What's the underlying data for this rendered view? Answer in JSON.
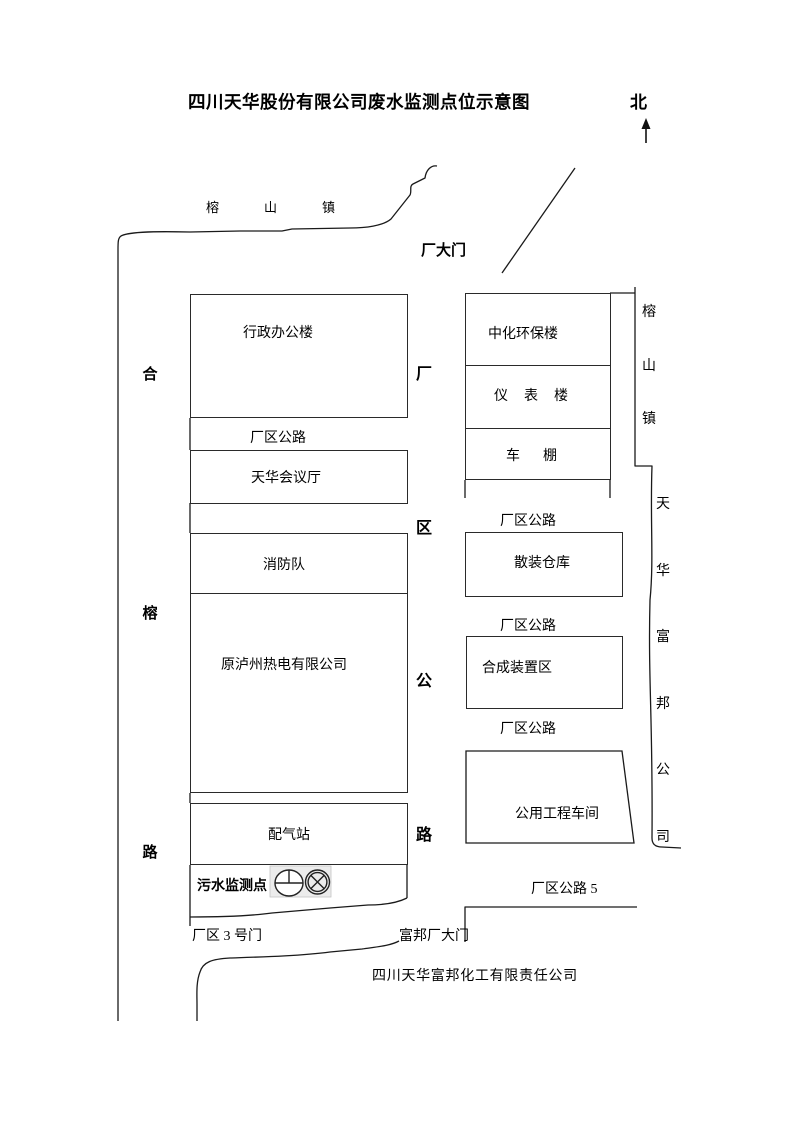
{
  "title": "四川天华股份有限公司废水监测点位示意图",
  "compass": {
    "north_label": "北",
    "arrow_icon": "north-up-arrow-icon"
  },
  "roads": {
    "town_top": "榕山镇",
    "left_vertical_road": "合榕路",
    "middle_vertical_road": "厂区公路",
    "right_vertical_town": "榕山镇",
    "right_vertical_company": "天华富邦公司",
    "factory_area_road": "厂区公路",
    "factory_area_road_5": "厂区公路 5"
  },
  "gates": {
    "main_gate": "厂大门",
    "gate_3": "厂区 3 号门",
    "fubang_gate": "富邦厂大门"
  },
  "buildings": {
    "admin": "行政办公楼",
    "conference": "天华会议厅",
    "fire": "消防队",
    "power": "原泸州热电有限公司",
    "gas": "配气站",
    "env": "中化环保楼",
    "instrument": "仪表楼",
    "shed": "车棚",
    "bulk": "散装仓库",
    "synth": "合成装置区",
    "utility": "公用工程车间"
  },
  "monitoring": {
    "label": "污水监测点",
    "symbol_1": "circle-crosshair-monitor-icon",
    "symbol_2": "circle-x-monitor-icon"
  },
  "company_bottom": "四川天华富邦化工有限责任公司",
  "colors": {
    "line": "#1a1a1a",
    "text": "#000000",
    "symbol_bg": "#ececec"
  }
}
